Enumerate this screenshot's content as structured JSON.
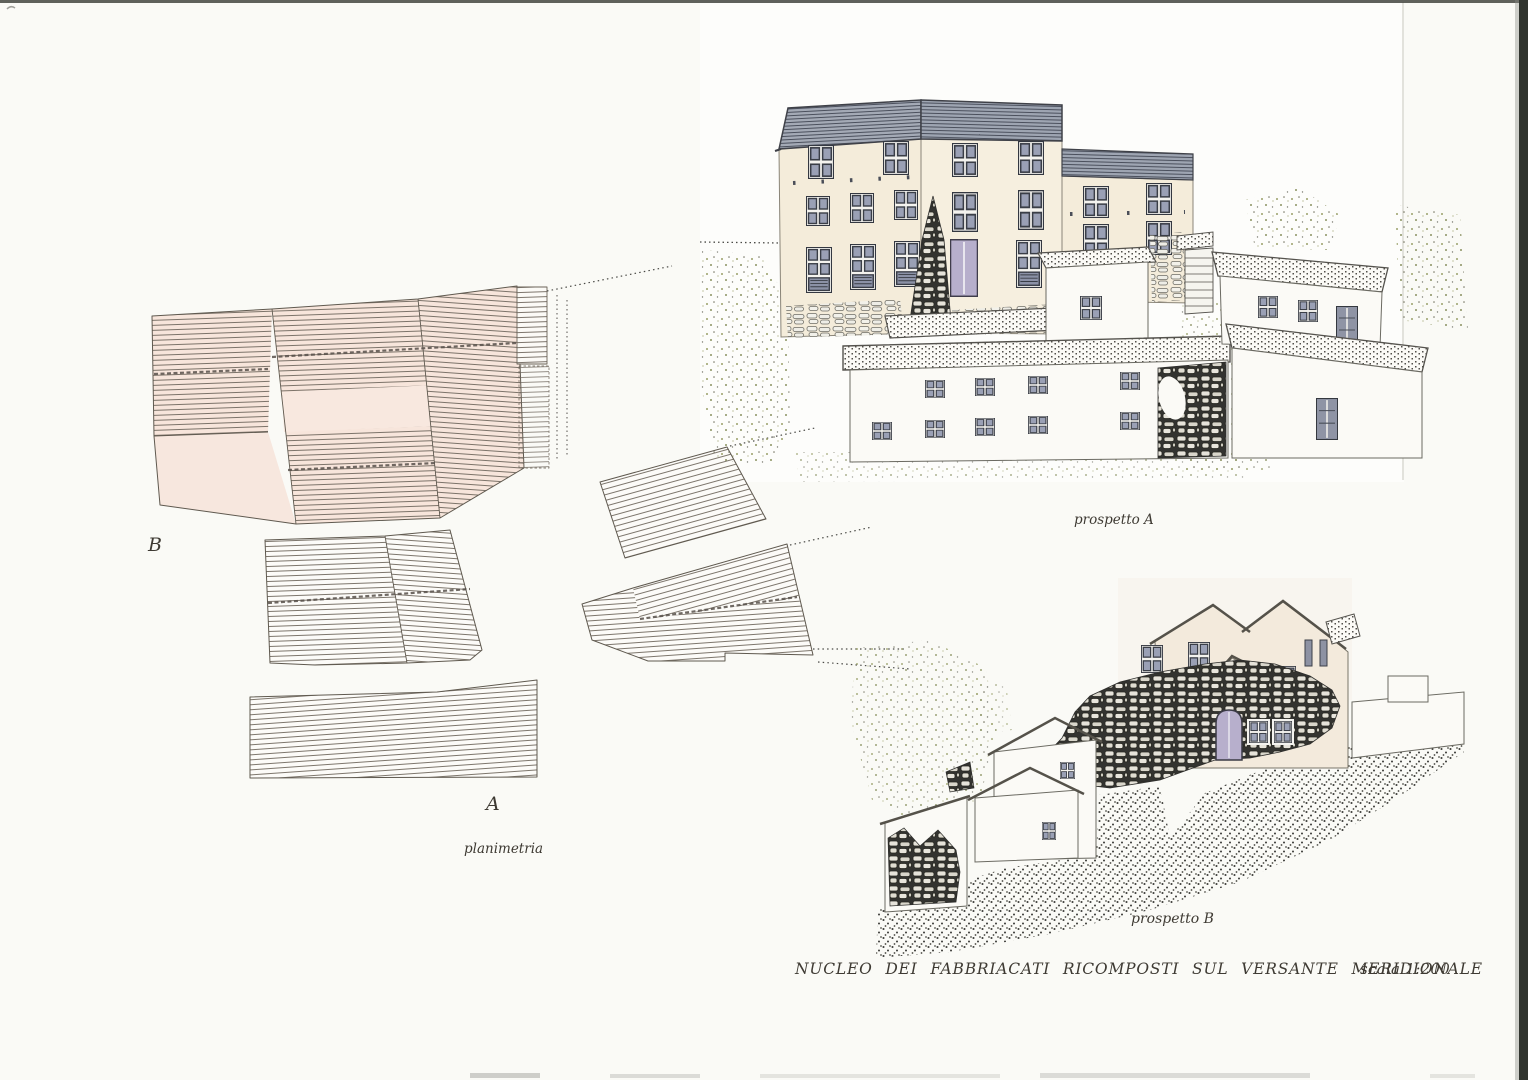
{
  "labels": {
    "marker_b": "B",
    "marker_a": "A",
    "plan_caption": "planimetria",
    "elevation_a_caption": "prospetto A",
    "elevation_b_caption": "prospetto B"
  },
  "footer": {
    "title": "NUCLEO  DEI  FABBRIACATI  RICOMPOSTI  SUL  VERSANTE  MERIDIONALE",
    "scale": "scala 1:200"
  },
  "palette": {
    "paper": "#fafaf6",
    "plan_tint": "#f7e5db",
    "roof_slate": "#a4aab6",
    "wall_cream": "#f4ecda",
    "window_pane": "#9aa0b5",
    "door_lilac": "#b7afcc",
    "stone_dark": "#333330",
    "ink": "#5f594f",
    "vegetation": "#99a069"
  }
}
